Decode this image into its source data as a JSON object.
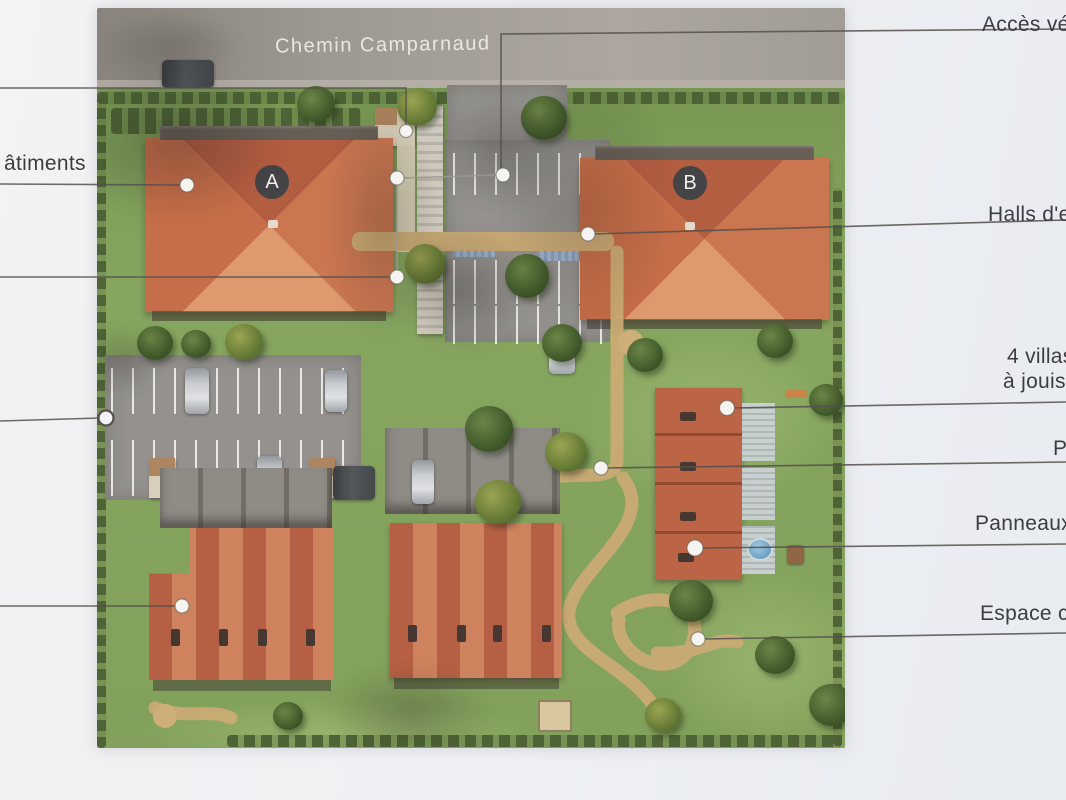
{
  "plan": {
    "street_label": "Chemin Camparnaud",
    "badges": {
      "building_a": "A",
      "building_b": "B"
    }
  },
  "callouts": {
    "left": [
      {
        "id": "batiments",
        "label": "âtiments"
      }
    ],
    "right": [
      {
        "id": "acces-vehicules",
        "label": "Accès véhi"
      },
      {
        "id": "halls-entree",
        "label": "Halls d'e"
      },
      {
        "id": "villas",
        "label_line1": "4 villas",
        "label_line2": "à jouiss"
      },
      {
        "id": "parking",
        "label": "Pa"
      },
      {
        "id": "panneaux",
        "label": "Panneaux p"
      },
      {
        "id": "espace-commun",
        "label": "Espace con"
      }
    ]
  },
  "colors": {
    "paper": "#eff0f3",
    "label_text": "#3c3d41",
    "callout_line": "#55504b",
    "roof_orange": "#c86f48",
    "grass_green": "#7e9f56",
    "road_gray": "#9b968e",
    "path_sand": "#c9a76e"
  }
}
